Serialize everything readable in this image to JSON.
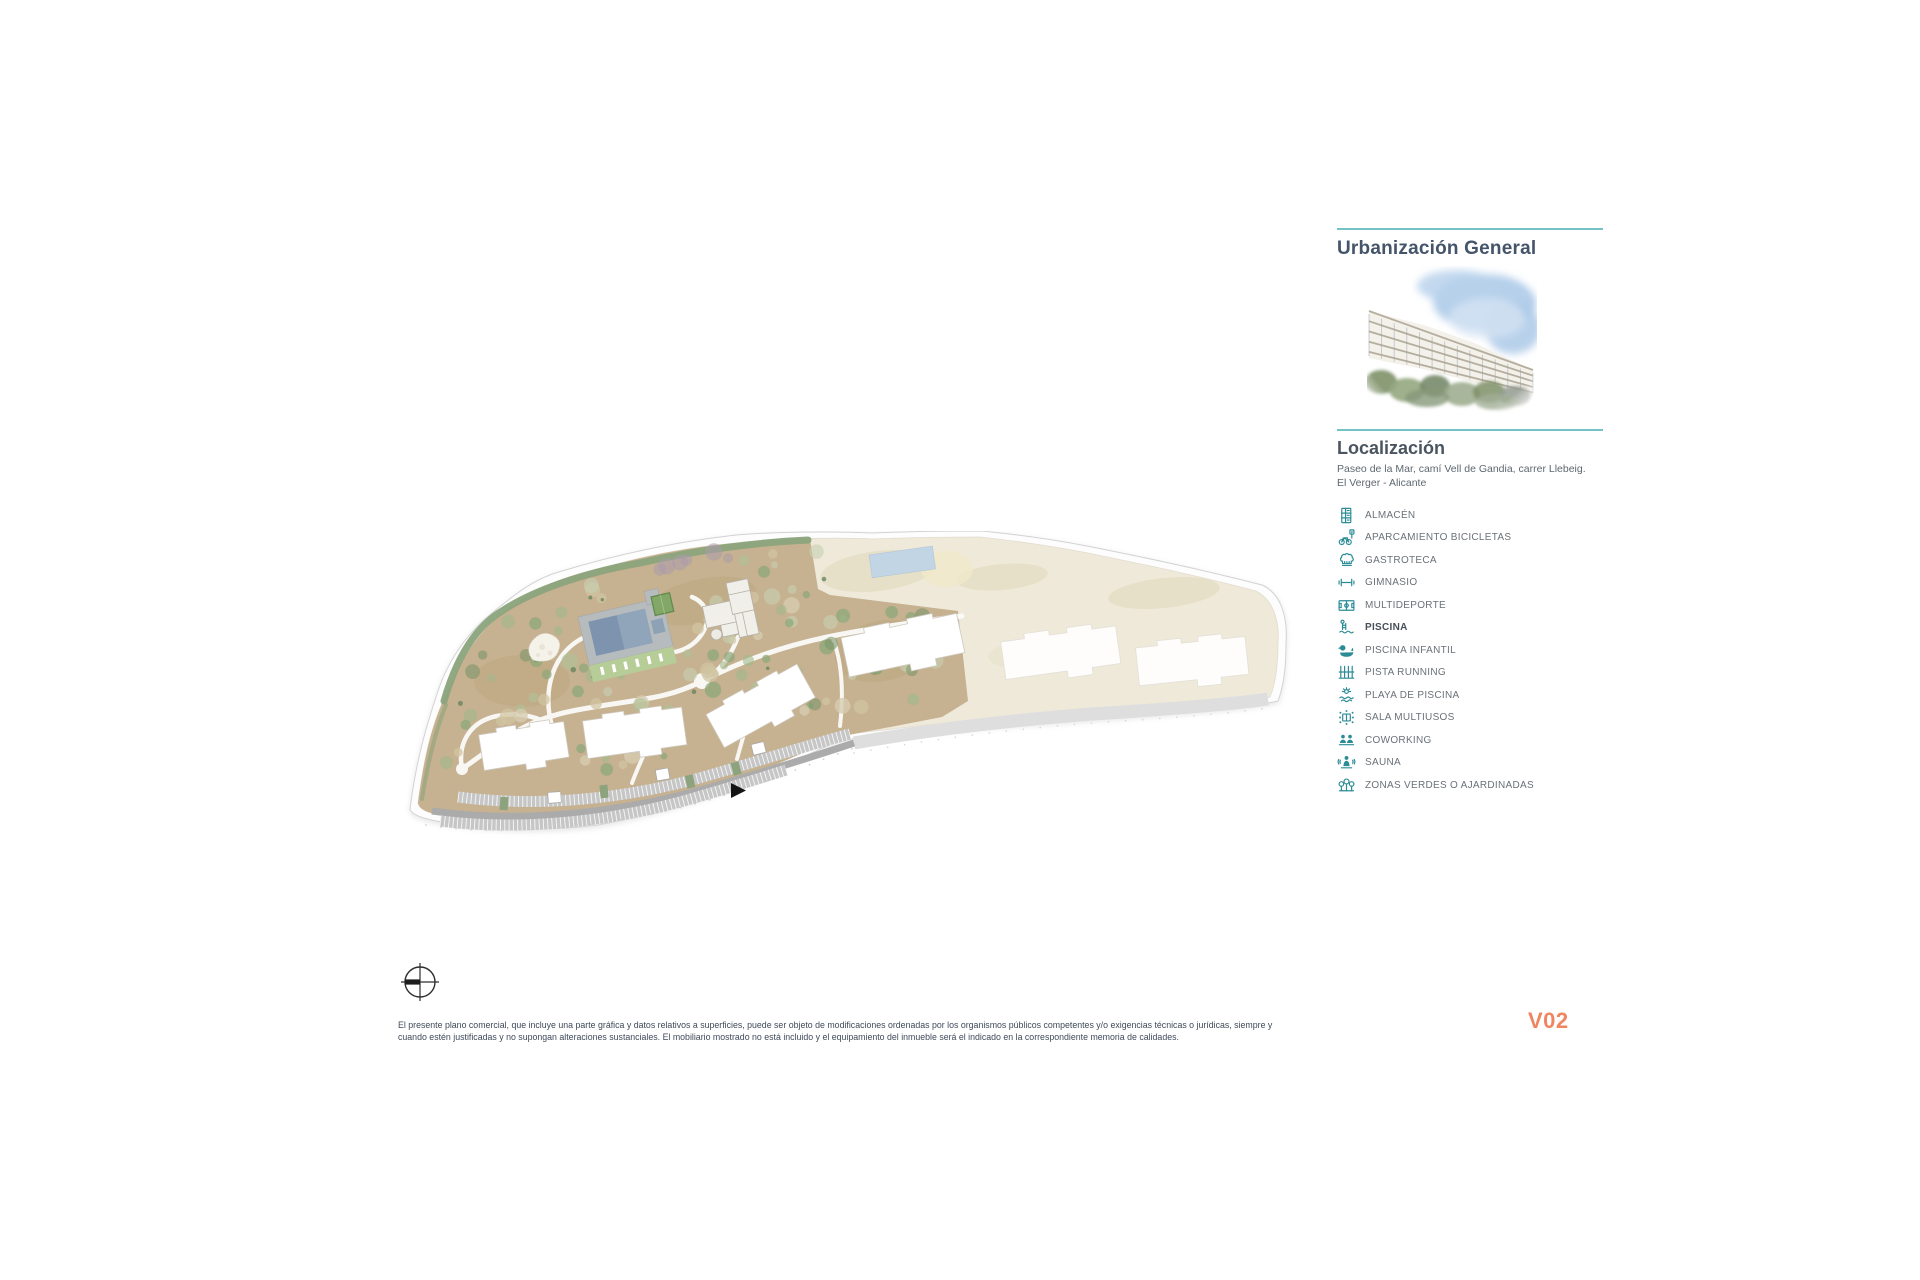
{
  "sidebar": {
    "title": "Urbanización General",
    "render_image": "watercolor-apartment-building-render",
    "location": {
      "heading": "Localización",
      "address": "Paseo de la Mar, camí Vell de Gandia, carrer Llebeig. El Verger - Alicante"
    },
    "legend": [
      {
        "icon": "storage-icon",
        "label": "ALMACÉN"
      },
      {
        "icon": "bike-parking-icon",
        "label": "APARCAMIENTO BICICLETAS"
      },
      {
        "icon": "chef-hat-icon",
        "label": "GASTROTECA"
      },
      {
        "icon": "dumbbell-icon",
        "label": "GIMNASIO"
      },
      {
        "icon": "sports-court-icon",
        "label": "MULTIDEPORTE"
      },
      {
        "icon": "pool-ladder-icon",
        "label": "PISCINA",
        "emphasis": true
      },
      {
        "icon": "rubber-duck-icon",
        "label": "PISCINA INFANTIL"
      },
      {
        "icon": "running-track-icon",
        "label": "PISTA RUNNING"
      },
      {
        "icon": "sun-water-icon",
        "label": "PLAYA DE PISCINA"
      },
      {
        "icon": "meeting-table-icon",
        "label": "SALA MULTIUSOS"
      },
      {
        "icon": "coworking-icon",
        "label": "COWORKING"
      },
      {
        "icon": "sauna-icon",
        "label": "SAUNA"
      },
      {
        "icon": "trees-icon",
        "label": "ZONAS VERDES O AJARDINADAS"
      }
    ]
  },
  "footer": {
    "disclaimer": "El presente plano comercial, que incluye una parte gráfica y datos relativos a superficies, puede ser objeto de modificaciones ordenadas por los organismos públicos competentes y/o exigencias técnicas o jurídicas, siempre y cuando estén justificadas y no supongan alteraciones sustanciales. El mobiliario mostrado no está incluido y el equipamiento del inmueble será el indicado en la correspondiente memoria de calidades.",
    "version_label": "V02"
  },
  "colors": {
    "accent_teal_line": "#74c2c6",
    "icon_teal": "#2b8c96",
    "heading_slate": "#44546a",
    "legend_text_gray": "#6b7178",
    "version_orange": "#ef8660"
  }
}
